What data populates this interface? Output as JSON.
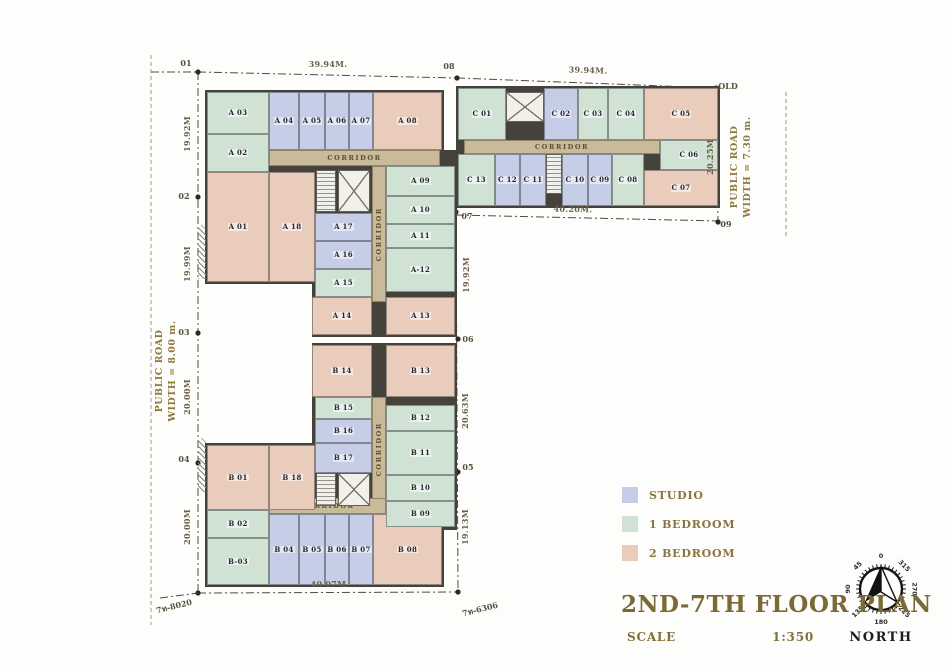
{
  "drawing": {
    "title": "2ND-7TH FLOOR PLAN",
    "scale_label": "SCALE",
    "scale_value": "1:350"
  },
  "legend": {
    "items": [
      {
        "id": "studio",
        "label": "STUDIO",
        "color": "#c6cde6"
      },
      {
        "id": "bed1",
        "label": "1 BEDROOM",
        "color": "#cfe2d4"
      },
      {
        "id": "bed2",
        "label": "2 BEDROOM",
        "color": "#eaccbd"
      }
    ]
  },
  "compass": {
    "label": "NORTH",
    "degrees": [
      "0",
      "45",
      "90",
      "135",
      "180",
      "225",
      "270",
      "315"
    ]
  },
  "roads": [
    {
      "id": "road-left",
      "line1": "PUBLIC ROAD",
      "line2": "WIDTH = 8.00 m."
    },
    {
      "id": "road-right",
      "line1": "PUBLIC ROAD",
      "line2": "WIDTH = 7.30 m."
    }
  ],
  "survey_points": [
    {
      "id": "p01",
      "label": "01"
    },
    {
      "id": "p02",
      "label": "02"
    },
    {
      "id": "p03",
      "label": "03"
    },
    {
      "id": "p04",
      "label": "04"
    },
    {
      "id": "p05",
      "label": "05"
    },
    {
      "id": "p06",
      "label": "06"
    },
    {
      "id": "p07",
      "label": "07"
    },
    {
      "id": "p08",
      "label": "08"
    },
    {
      "id": "p09",
      "label": "09"
    },
    {
      "id": "pold",
      "label": "OLD"
    },
    {
      "id": "pbl",
      "label": "7ท-8020"
    },
    {
      "id": "pbm",
      "label": "7ท-6306"
    }
  ],
  "dimensions": [
    {
      "id": "dim-top-a",
      "label": "39.94M."
    },
    {
      "id": "dim-top-c",
      "label": "39.94M."
    },
    {
      "id": "dim-left-1",
      "label": "19.92M"
    },
    {
      "id": "dim-left-2",
      "label": "19.99M"
    },
    {
      "id": "dim-left-3",
      "label": "20.00M"
    },
    {
      "id": "dim-left-4",
      "label": "20.00M"
    },
    {
      "id": "dim-mid-1",
      "label": "19.92M"
    },
    {
      "id": "dim-mid-2",
      "label": "20.63M"
    },
    {
      "id": "dim-mid-3",
      "label": "19.13M"
    },
    {
      "id": "dim-bot-b",
      "label": "40.07M."
    },
    {
      "id": "dim-bot-c",
      "label": "40.20M."
    },
    {
      "id": "dim-right-c",
      "label": "20.25M"
    }
  ],
  "corridors": [
    {
      "id": "corr-a-h",
      "label": "CORRIDOR"
    },
    {
      "id": "corr-a-v",
      "label": "CORRIDOR"
    },
    {
      "id": "corr-b-v",
      "label": "CORRIDOR"
    },
    {
      "id": "corr-b-h",
      "label": "CORRIDOR"
    },
    {
      "id": "corr-c-h",
      "label": "CORRIDOR"
    }
  ],
  "buildings": [
    {
      "id": "A",
      "units": [
        {
          "label": "A 01",
          "type": "bed2"
        },
        {
          "label": "A 02",
          "type": "bed1"
        },
        {
          "label": "A 03",
          "type": "bed1"
        },
        {
          "label": "A 04",
          "type": "studio"
        },
        {
          "label": "A 05",
          "type": "studio"
        },
        {
          "label": "A 06",
          "type": "studio"
        },
        {
          "label": "A 07",
          "type": "studio"
        },
        {
          "label": "A 08",
          "type": "bed2"
        },
        {
          "label": "A 09",
          "type": "bed1"
        },
        {
          "label": "A 10",
          "type": "bed1"
        },
        {
          "label": "A 11",
          "type": "bed1"
        },
        {
          "label": "A-12",
          "type": "bed1"
        },
        {
          "label": "A 13",
          "type": "bed2"
        },
        {
          "label": "A 14",
          "type": "bed2"
        },
        {
          "label": "A 15",
          "type": "bed1"
        },
        {
          "label": "A 16",
          "type": "studio"
        },
        {
          "label": "A 17",
          "type": "studio"
        },
        {
          "label": "A 18",
          "type": "bed2"
        }
      ]
    },
    {
      "id": "B",
      "units": [
        {
          "label": "B 01",
          "type": "bed2"
        },
        {
          "label": "B 02",
          "type": "bed1"
        },
        {
          "label": "B-03",
          "type": "bed1"
        },
        {
          "label": "B 04",
          "type": "studio"
        },
        {
          "label": "B 05",
          "type": "studio"
        },
        {
          "label": "B 06",
          "type": "studio"
        },
        {
          "label": "B 07",
          "type": "studio"
        },
        {
          "label": "B 08",
          "type": "bed2"
        },
        {
          "label": "B 09",
          "type": "bed1"
        },
        {
          "label": "B 10",
          "type": "bed1"
        },
        {
          "label": "B 11",
          "type": "bed1"
        },
        {
          "label": "B 12",
          "type": "bed1"
        },
        {
          "label": "B 13",
          "type": "bed2"
        },
        {
          "label": "B 14",
          "type": "bed2"
        },
        {
          "label": "B 15",
          "type": "bed1"
        },
        {
          "label": "B 16",
          "type": "studio"
        },
        {
          "label": "B 17",
          "type": "studio"
        },
        {
          "label": "B 18",
          "type": "bed2"
        }
      ]
    },
    {
      "id": "C",
      "units": [
        {
          "label": "C 01",
          "type": "bed1"
        },
        {
          "label": "C 02",
          "type": "studio"
        },
        {
          "label": "C 03",
          "type": "bed1"
        },
        {
          "label": "C 04",
          "type": "bed1"
        },
        {
          "label": "C 05",
          "type": "bed2"
        },
        {
          "label": "C 06",
          "type": "bed1"
        },
        {
          "label": "C 07",
          "type": "bed2"
        },
        {
          "label": "C 08",
          "type": "bed1"
        },
        {
          "label": "C 09",
          "type": "studio"
        },
        {
          "label": "C 10",
          "type": "studio"
        },
        {
          "label": "C 11",
          "type": "studio"
        },
        {
          "label": "C 12",
          "type": "studio"
        },
        {
          "label": "C 13",
          "type": "bed1"
        }
      ]
    }
  ]
}
